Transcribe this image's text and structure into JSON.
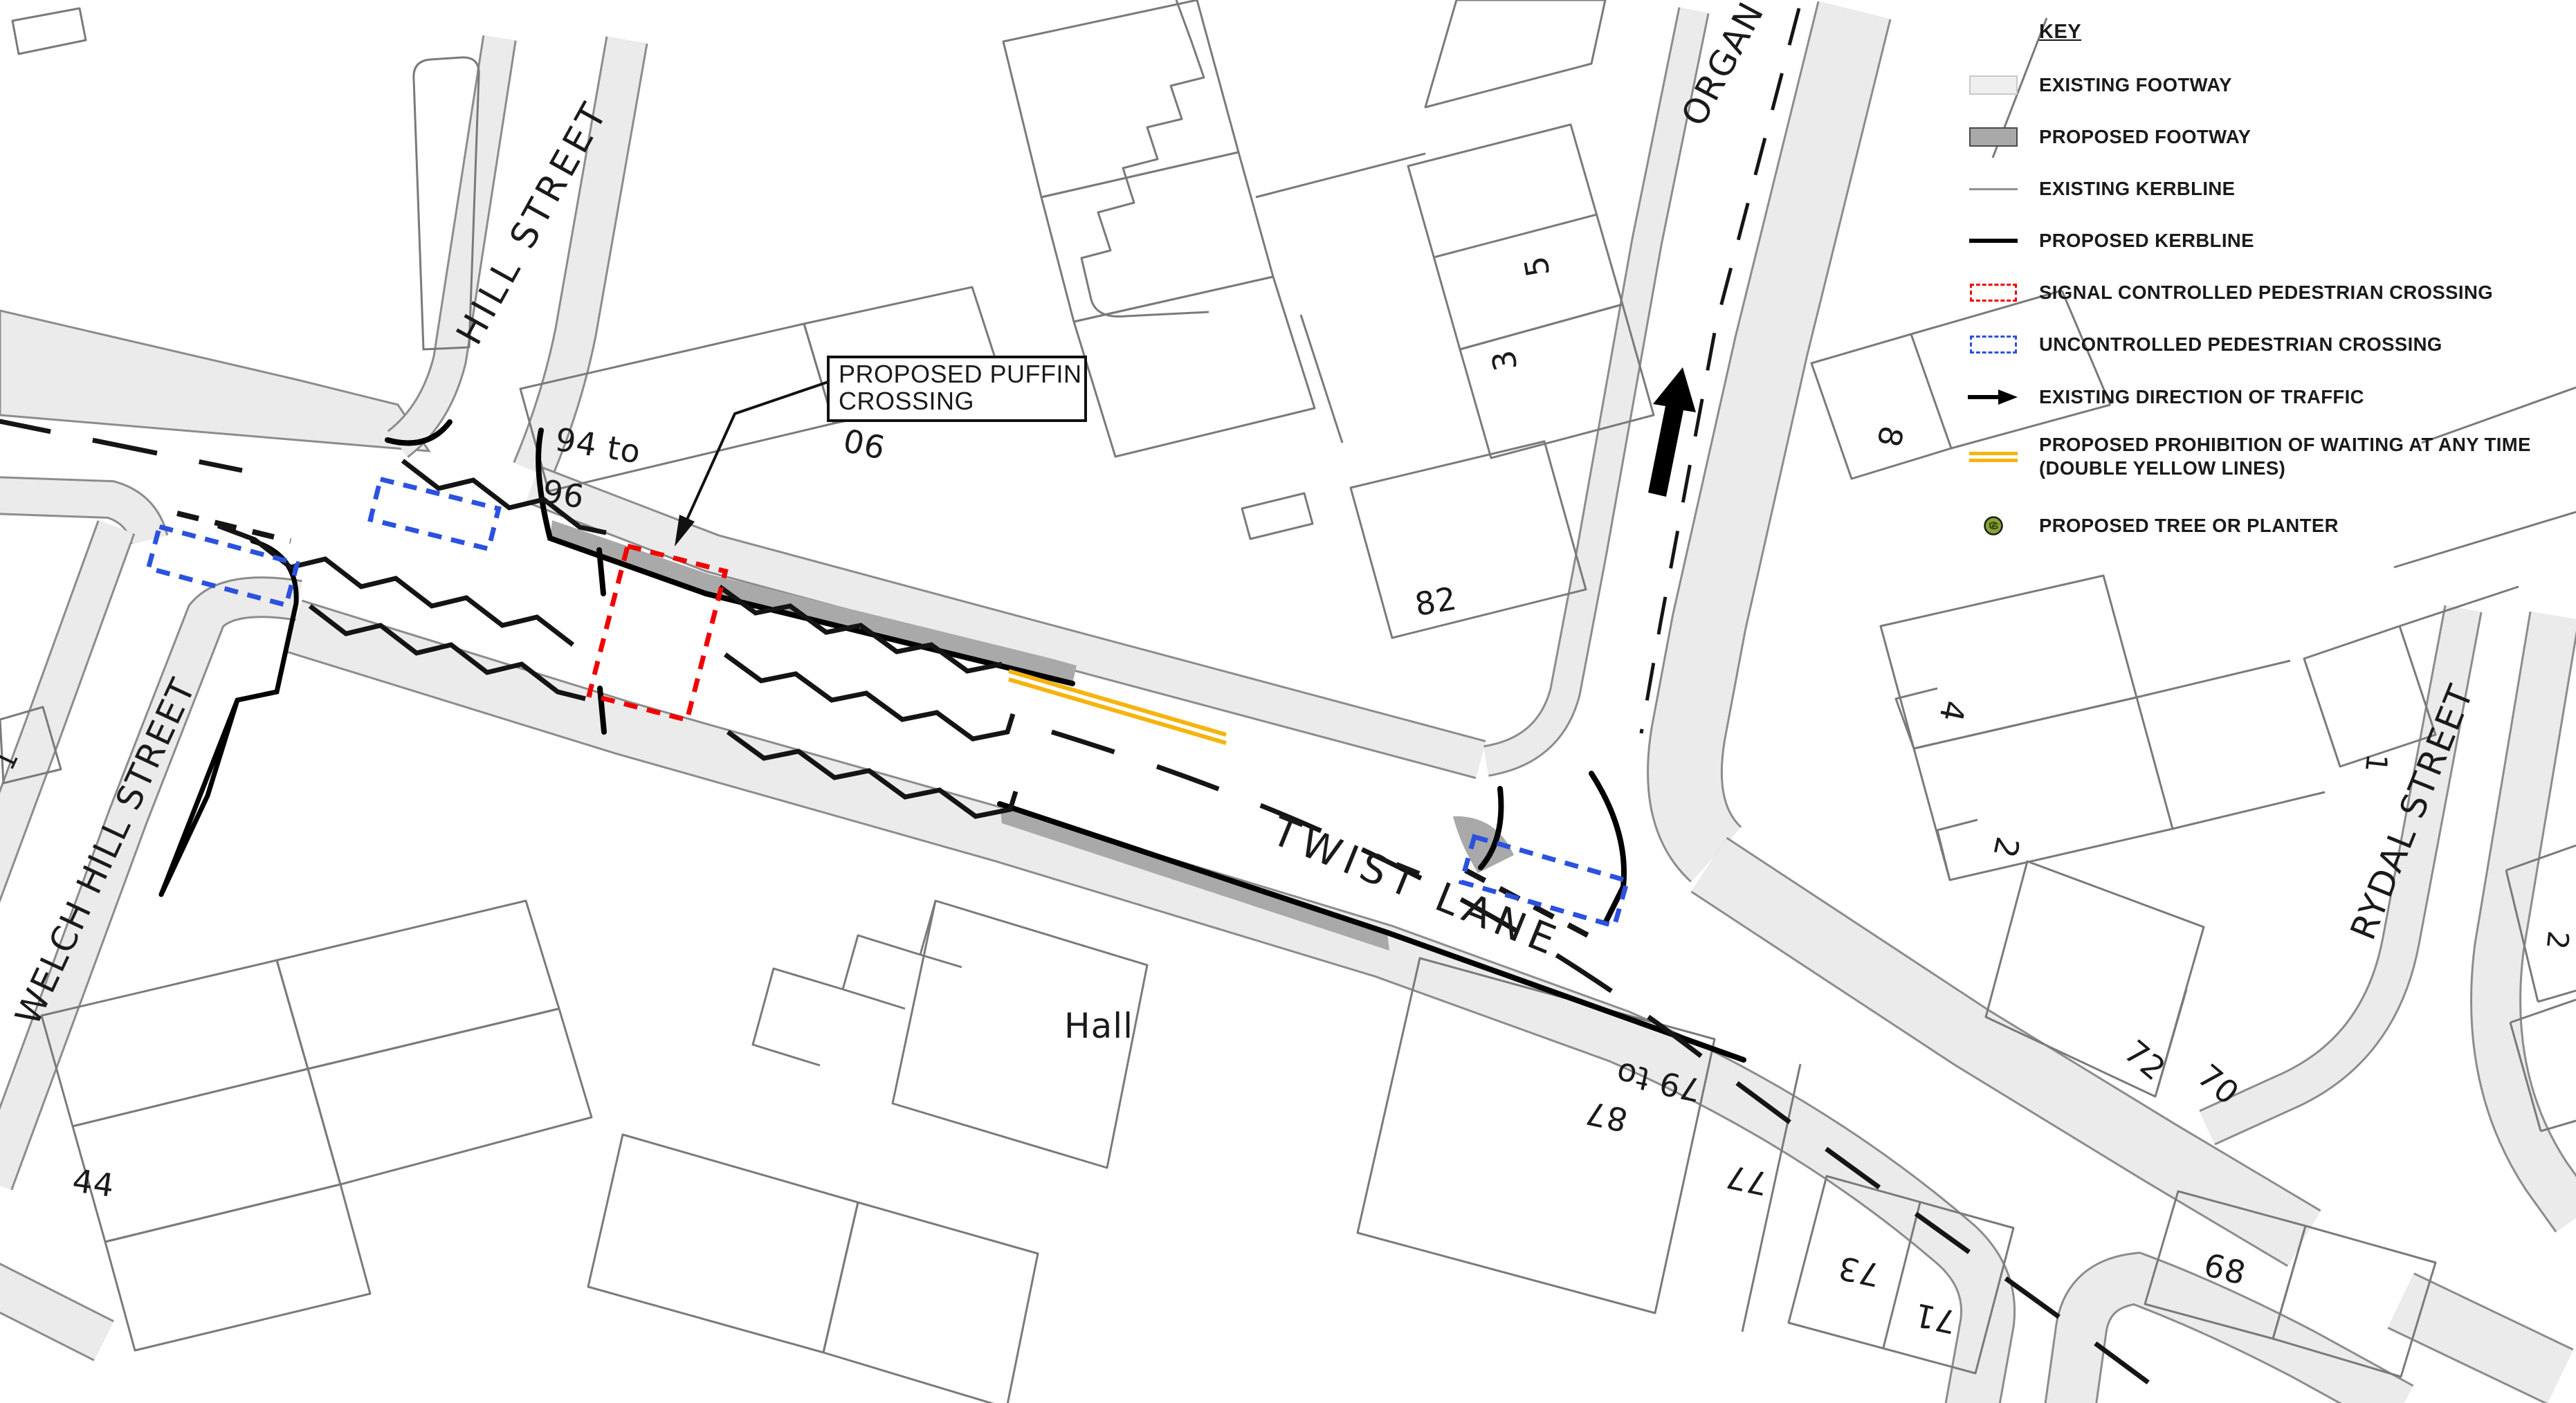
{
  "colors": {
    "signal_crossing_red": "#F20000",
    "uncontrolled_crossing_blue": "#2B52DE",
    "double_yellow": "#F5B40E",
    "existing_footway": "#EBEBEB",
    "proposed_footway": "#A9A9A9",
    "existing_kerbline": "#8C8C8C",
    "proposed_kerbline": "#000000",
    "tree_green": "#86A32F"
  },
  "legend": {
    "title": "KEY",
    "items": [
      {
        "id": "existing-footway",
        "label": "EXISTING FOOTWAY"
      },
      {
        "id": "proposed-footway",
        "label": "PROPOSED FOOTWAY"
      },
      {
        "id": "existing-kerbline",
        "label": "EXISTING KERBLINE"
      },
      {
        "id": "proposed-kerbline",
        "label": "PROPOSED KERBLINE"
      },
      {
        "id": "signal-crossing",
        "label": "SIGNAL CONTROLLED PEDESTRIAN CROSSING"
      },
      {
        "id": "uncontrolled-crossing",
        "label": "UNCONTROLLED PEDESTRIAN CROSSING"
      },
      {
        "id": "direction-of-traffic",
        "label": "EXISTING DIRECTION OF TRAFFIC"
      },
      {
        "id": "waiting-prohibition",
        "label": "PROPOSED PROHIBITION OF WAITING AT ANY TIME",
        "label2": "(DOUBLE YELLOW LINES)"
      },
      {
        "id": "tree-planter",
        "label": "PROPOSED TREE OR PLANTER"
      }
    ]
  },
  "callout": {
    "line1": "PROPOSED PUFFIN",
    "line2": "CROSSING"
  },
  "streets": {
    "hill": "HILL STREET",
    "welch": "WELCH HILL STREET",
    "twist": "TWIST LANE",
    "organ": "ORGAN",
    "rydal": "RYDAL STREET"
  },
  "numbers": {
    "n94": "94 to",
    "n96": "96",
    "n90": "90",
    "n5": "5",
    "n3": "3",
    "n82": "82",
    "n8": "8",
    "n4": "4",
    "n2a": "2",
    "n1a": "1",
    "n2b": "2",
    "n72": "72",
    "n70": "70",
    "n68": "68",
    "n44": "44",
    "hall": "Hall",
    "n79": "79 to",
    "n87": "87",
    "n77": "77",
    "n73": "73",
    "n71": "71",
    "n1b": "1"
  }
}
